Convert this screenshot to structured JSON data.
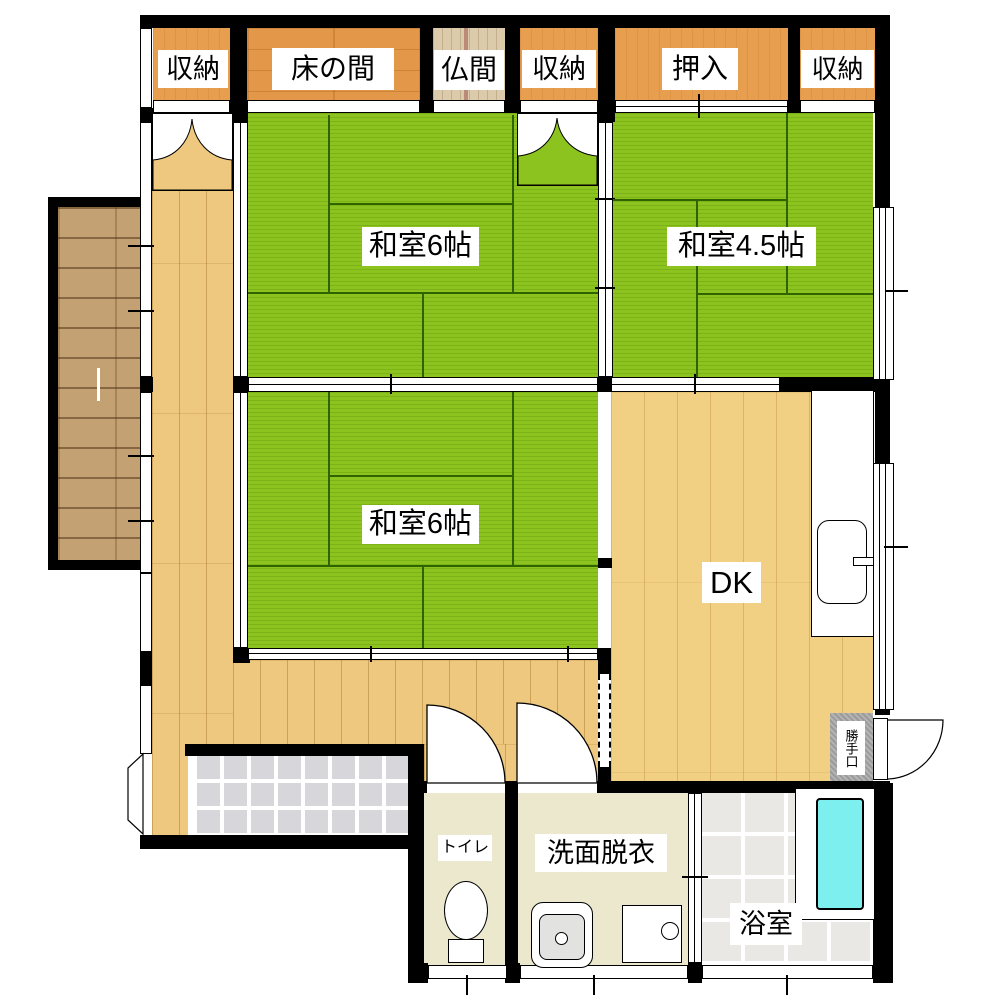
{
  "plan": {
    "closets": [
      {
        "label": "収納"
      },
      {
        "label": "床の間"
      },
      {
        "label": "仏間"
      },
      {
        "label": "収納"
      },
      {
        "label": "押入"
      },
      {
        "label": "収納"
      }
    ],
    "rooms": [
      {
        "label": "和室6帖"
      },
      {
        "label": "和室4.5帖"
      },
      {
        "label": "和室6帖"
      },
      {
        "label": "DK"
      },
      {
        "label": "トイレ"
      },
      {
        "label": "洗面脱衣"
      },
      {
        "label": "浴室"
      },
      {
        "label": "勝手口"
      }
    ],
    "colors": {
      "tatami": "#8CC31E",
      "corridor_wood": "#EDC87E",
      "dk_wood": "#F2D083",
      "closet_wood": "#E79E4F",
      "tokonoma_wood": "#E39749",
      "butsuma_wood": "#DBCBAA",
      "deck_wood": "#C4A172",
      "wall": "#000000",
      "bathtub": "#7EEFEF",
      "genkan_tile": "#D6D6DB",
      "bath_tile": "#E9E8E5",
      "wet_floor": "#EBE8CE",
      "backdoor_gray": "#9B9B9B"
    }
  }
}
